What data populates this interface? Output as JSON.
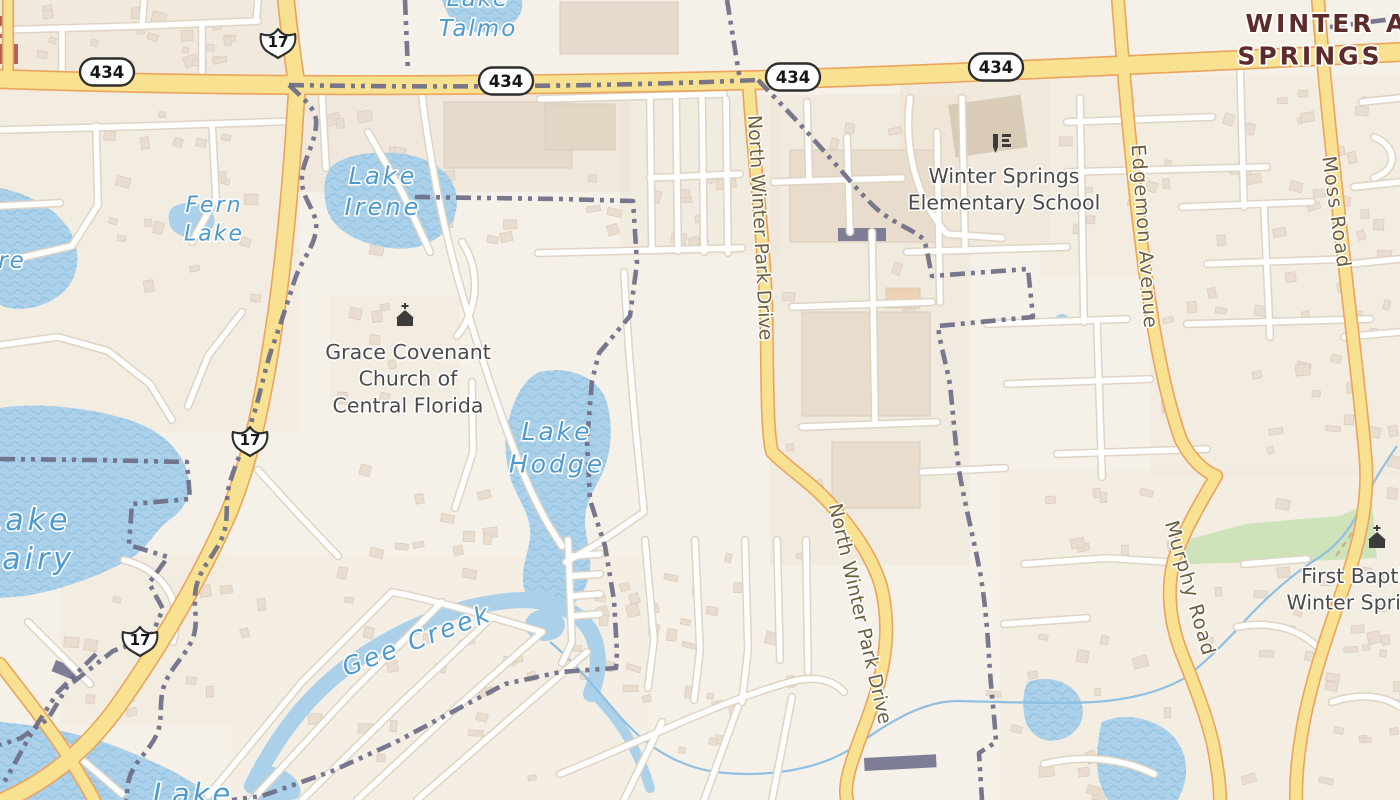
{
  "map": {
    "width": 1400,
    "height": 800,
    "colors": {
      "land": "#f6f1e8",
      "water": "#abd0ea",
      "waterWave": "#96c5e2",
      "waterLabel": "#4f9acc",
      "roadYellow": "#f8e292",
      "roadCasing": "#eca35c",
      "whiteRoad": "#ffffff",
      "whiteCasing": "#ded4c4",
      "boundary": "#6d6d86",
      "green": "#cfe3ba",
      "trail": "#cbb489",
      "building": "#e8ddcf",
      "buildingStroke": "#d8ccbc",
      "darkBuilding": "#7d7d95",
      "redBuilding": "#b2605c",
      "cityLabel": "#5e2b2b",
      "poiLabel": "#4b4b4b",
      "roadLabel": "#6e5e3e",
      "stream": "#8fc0e2",
      "shieldStroke": "#2e2e2e"
    },
    "landuse": [
      [
        0,
        0,
        300,
        92,
        "#ebe1d1",
        0.55
      ],
      [
        300,
        92,
        330,
        100,
        "#eae0d0",
        0.5
      ],
      [
        0,
        92,
        300,
        340,
        "#efe6d8",
        0.4
      ],
      [
        620,
        95,
        160,
        160,
        "#eee4d5",
        0.45
      ],
      [
        770,
        95,
        200,
        470,
        "#ebe2d3",
        0.45
      ],
      [
        900,
        80,
        150,
        165,
        "#ece2d2",
        0.55
      ],
      [
        1040,
        75,
        360,
        200,
        "#f0e7d9",
        0.5
      ],
      [
        1150,
        275,
        250,
        200,
        "#f0e7d9",
        0.45
      ],
      [
        1000,
        470,
        400,
        330,
        "#f0e8db",
        0.45
      ],
      [
        230,
        555,
        420,
        245,
        "#f2ebdf",
        0.5
      ],
      [
        60,
        555,
        170,
        170,
        "#efe6d8",
        0.4
      ],
      [
        330,
        295,
        130,
        110,
        "#efe6d8",
        0.4
      ]
    ],
    "green_areas": [
      "M1178,542 L1246,524 L1300,519 L1340,516 L1372,502 L1377,558 L1310,561 L1186,564 Z"
    ],
    "green_trails": [
      "M1336,556 C1344,544 1352,534 1358,522"
    ],
    "water": [
      {
        "id": "lake-talmo",
        "wave": true,
        "d": "M442,0 L522,0 C524,12 516,25 500,30 C480,36 458,30 450,18 C446,10 443,4 442,0 Z"
      },
      {
        "id": "lake-irene",
        "wave": true,
        "d": "M330,168 C345,152 390,148 420,158 C450,168 462,190 455,215 C448,238 420,252 390,248 C355,243 330,228 326,205 C323,190 324,178 330,168 Z"
      },
      {
        "id": "fern-pond",
        "wave": false,
        "d": "M172,208 C182,200 205,202 212,212 C218,222 212,234 198,237 C184,240 170,232 169,222 C168,215 169,211 172,208 Z"
      },
      {
        "id": "left-lake",
        "wave": true,
        "d": "M0,188 C30,194 60,210 72,235 C82,258 78,280 60,295 C40,310 15,312 0,305 Z"
      },
      {
        "id": "lake-hodge",
        "wave": true,
        "d": "M540,372 C570,365 598,378 606,400 C614,425 612,455 600,478 C592,494 585,505 585,520 C585,538 592,552 590,570 C587,592 575,608 558,612 C542,615 528,605 524,588 C520,570 528,555 530,538 C532,522 524,508 516,492 C505,470 502,440 510,415 C516,395 525,378 540,372 Z"
      },
      {
        "id": "lake-fairy",
        "wave": true,
        "d": "M0,408 C40,402 95,408 135,422 C162,432 178,448 186,468 C192,486 190,505 172,518 C152,532 150,548 128,560 C100,576 60,590 25,596 L0,598 Z"
      },
      {
        "id": "bottom-lake",
        "wave": true,
        "d": "M0,722 C40,725 90,735 130,752 C170,768 200,785 215,800 L0,800 Z"
      },
      {
        "id": "bottom-pond",
        "wave": false,
        "d": "M252,768 C275,762 295,772 300,788 C302,796 298,800 290,800 L255,800 C250,785 248,775 252,768 Z"
      },
      {
        "id": "creek-bulge",
        "wave": false,
        "d": "M525,625 a20,16 0 1,0 40,0 a20,16 0 1,0 -40,0 Z"
      },
      {
        "id": "pond-se-1",
        "wave": true,
        "d": "M1028,682 C1045,675 1068,680 1078,695 C1088,712 1082,730 1065,738 C1048,745 1032,738 1026,722 C1022,708 1022,692 1028,682 Z"
      },
      {
        "id": "pond-se-2",
        "wave": true,
        "d": "M1102,722 C1125,712 1155,718 1172,735 C1188,752 1190,775 1180,795 L1178,800 L1108,800 C1098,785 1095,765 1098,745 C1099,735 1100,728 1102,722 Z"
      },
      {
        "id": "pond-tiny",
        "wave": false,
        "d": "M1055,320 a7,6 0 1,0 14,0 a7,6 0 1,0 -14,0 Z"
      }
    ],
    "creek_strokes": [
      {
        "w": 16,
        "d": "M252,786 C282,726 317,686 362,656 C407,626 457,606 507,601 C547,597 577,608 591,632 C601,652 599,674 591,694"
      },
      {
        "w": 10,
        "d": "M589,690 C615,712 638,748 650,788"
      }
    ],
    "streams": [
      "M1397,446 C1380,470 1370,488 1362,505 C1348,535 1332,550 1312,562 C1285,580 1262,602 1242,624 C1222,646 1205,662 1188,676 C1162,692 1128,700 1094,702 C1055,704 1000,702 960,701 C920,700 885,726 852,748 C818,770 766,778 716,772 C673,766 641,742 616,712 C592,684 570,658 550,642"
    ],
    "yellow_roads": [
      {
        "id": "sr-434",
        "w": 17,
        "d": "M0,79 C250,88 520,86 760,80 C950,74 1200,62 1400,52"
      },
      {
        "id": "us-17-north",
        "w": 15,
        "d": "M286,0 C289,30 293,60 297,86"
      },
      {
        "id": "us-17-south",
        "w": 15,
        "d": "M297,86 C292,170 285,260 272,340 C262,405 250,460 230,510 C205,568 165,640 118,706 C85,752 45,782 5,800"
      },
      {
        "id": "sw-secondary",
        "w": 11,
        "d": "M0,664 C28,700 48,726 64,750 C78,772 88,788 94,800"
      },
      {
        "id": "north-winter-park-drive",
        "w": 11,
        "d": "M749,88 C753,150 763,230 766,300 C768,370 766,425 772,452 C790,470 812,483 832,506 C852,529 872,556 881,586 C888,614 888,645 880,678 C872,712 858,740 850,768 C846,782 845,792 847,800"
      },
      {
        "id": "edgemon-avenue",
        "w": 11,
        "d": "M1118,0 C1124,80 1131,160 1141,240 C1151,320 1163,390 1181,440 C1192,461 1204,471 1216,476"
      },
      {
        "id": "murphy-road",
        "w": 11,
        "d": "M1216,476 C1200,504 1184,530 1174,560 C1166,590 1170,624 1182,654 C1194,684 1206,714 1213,744 C1218,770 1220,788 1220,800"
      },
      {
        "id": "moss-road",
        "w": 11,
        "d": "M1318,0 C1325,90 1335,180 1345,268 C1353,340 1363,420 1366,465 C1368,506 1359,546 1344,586 C1329,630 1311,680 1303,726 C1297,760 1296,780 1296,800"
      },
      {
        "id": "left-edge-stub",
        "w": 9,
        "d": "M8,0 L8,72"
      }
    ],
    "white_roads": [
      "M0,30 L140,26 L258,21",
      "M142,26 L144,0",
      "M256,21 L258,0",
      "M62,28 L62,80",
      "M202,24 L202,80",
      "M0,130 L150,126 L300,121",
      "M96,126 L98,205 L72,246 L20,258",
      "M212,124 L216,198 L192,242",
      "M0,206 L60,203",
      "M0,345 L58,337 L108,351 L150,384 L172,420",
      "M242,312 L208,356 L188,406",
      "M258,470 L300,516 L338,556",
      "M124,560 C163,570 184,600 173,642",
      "M28,622 L90,684",
      "M64,744 L122,794",
      "M322,96 L326,168",
      "M422,96 C430,162 444,232 464,300 C482,360 502,420 522,470 C534,500 548,526 562,546",
      "M368,132 L402,192 L430,252",
      "M462,242 C482,272 477,312 457,336",
      "M472,382 L473,452 L455,508",
      "M624,272 L629,352 L636,432 L644,512",
      "M644,512 L602,541 L566,562",
      "M540,99 L724,94",
      "M650,99 L652,250",
      "M676,99 L678,251",
      "M702,99 L704,252",
      "M726,99 L728,253",
      "M650,178 L740,174",
      "M538,253 L742,248",
      "M208,796 L302,682 L392,592",
      "M252,800 L352,692 L442,602",
      "M302,800 L402,702 L492,617",
      "M357,800 L457,707 L542,632",
      "M417,800 L512,717 L587,652",
      "M392,592 C442,602 492,617 542,632",
      "M568,540 L572,642 L562,663",
      "M572,556 L600,554",
      "M572,576 L600,574",
      "M572,596 L600,594",
      "M572,616 L600,614",
      "M645,540 L654,640 L648,688",
      "M695,540 L700,650 L694,700",
      "M745,540 L748,650 L742,702",
      "M777,540 L780,660",
      "M806,540 L808,672",
      "M560,774 C640,742 718,702 790,682 C816,675 833,680 844,692",
      "M624,800 L662,722",
      "M704,800 L738,707",
      "M772,800 L792,697",
      "M774,182 L902,178",
      "M792,307 L932,302",
      "M802,427 L937,422",
      "M937,132 L940,302",
      "M872,232 L875,422",
      "M807,102 L809,178",
      "M847,137 L850,232",
      "M922,472 L1005,468",
      "M962,98 L965,247",
      "M907,252 L1067,247",
      "M910,98 C904,145 914,196 947,234 L1002,238",
      "M1067,122 L1212,117",
      "M1067,172 L1267,167",
      "M987,324 L1127,319",
      "M1182,207 L1312,202",
      "M1207,264 L1347,259",
      "M1187,324 L1370,319",
      "M1007,384 L1150,379",
      "M1057,454 L1207,449",
      "M1080,98 L1084,322",
      "M1240,64 L1244,207",
      "M1264,207 L1270,337",
      "M1097,324 L1102,477",
      "M1362,102 L1400,98",
      "M1354,187 L1400,182",
      "M1350,264 L1400,259",
      "M1344,337 L1400,332",
      "M1374,137 C1398,147 1398,170 1374,178",
      "M1024,564 L1107,558 L1167,562",
      "M1004,624 L1087,618",
      "M1244,564 L1307,559",
      "M1237,627 C1274,620 1304,630 1324,654",
      "M1044,764 C1084,754 1124,759 1154,774",
      "M1332,702 C1362,692 1387,697 1400,707"
    ],
    "boundaries": [
      "M405,0 L408,72",
      "M727,0 L740,80",
      "M289,85 C450,88 620,86 758,80",
      "M758,80 C775,98 795,118 814,140 C838,166 858,192 878,210 C898,226 915,230 924,240 C928,252 929,264 932,276 L1028,269 L1033,317 L938,326 C940,345 946,362 950,385 C953,412 955,440 959,470 C965,505 974,540 980,572 C986,606 988,640 990,672 C992,700 995,722 996,742 L979,753 C980,770 981,785 982,800",
      "M289,85 C305,100 318,110 316,126 C314,148 300,164 302,184 C304,202 318,212 316,230 C314,248 300,262 294,282 C287,304 280,326 272,348 C264,372 260,396 252,420 C246,442 236,462 230,482 C224,502 230,520 222,538 C214,556 200,568 196,588 C192,606 200,622 192,640 C184,658 170,668 164,686 C158,704 164,720 156,736 C148,752 136,760 130,776 C126,788 128,794 126,800",
      "M0,459 L92,460 L187,462 L190,499 L132,504 L129,545 L168,557 L149,583 L163,609 L151,637 L113,651 L67,687 L48,719 L21,738 L0,745",
      "M96,654 L58,692 L32,732 L10,772 L2,786",
      "M415,197 L560,199 L633,201 L637,263 L630,316 L599,353 L592,381 L587,441 L590,500 L605,546 L614,600 L617,652 L616,668 L560,672 L505,684 L452,712 L396,742 L330,772 L262,796 L232,800",
      "M1330,27 L1400,18"
    ],
    "big_buildings": [
      {
        "x": 560,
        "y": 2,
        "w": 118,
        "h": 52,
        "rot": 0,
        "fill": "#e5dacb"
      },
      {
        "x": 444,
        "y": 102,
        "w": 128,
        "h": 66,
        "rot": 0,
        "fill": "#e5dacb"
      },
      {
        "x": 545,
        "y": 104,
        "w": 70,
        "h": 46,
        "rot": 0,
        "fill": "#e2d6c5"
      },
      {
        "x": 790,
        "y": 150,
        "w": 148,
        "h": 92,
        "rot": 0,
        "fill": "#e8ddcc"
      },
      {
        "x": 802,
        "y": 312,
        "w": 128,
        "h": 104,
        "rot": 0,
        "fill": "#e8ddcc"
      },
      {
        "x": 832,
        "y": 442,
        "w": 88,
        "h": 66,
        "rot": 0,
        "fill": "#e8ddcc"
      },
      {
        "x": 952,
        "y": 100,
        "w": 72,
        "h": 52,
        "rot": -8,
        "fill": "#d9cbb6"
      },
      {
        "x": 886,
        "y": 288,
        "w": 34,
        "h": 20,
        "rot": 0,
        "fill": "#edd2b4"
      }
    ],
    "dark_buildings": [
      {
        "x": 838,
        "y": 228,
        "w": 48,
        "h": 13,
        "rot": 0
      },
      {
        "x": 864,
        "y": 758,
        "w": 72,
        "h": 13,
        "rot": -3
      },
      {
        "x": 56,
        "y": 660,
        "w": 26,
        "h": 12,
        "rot": 22
      }
    ],
    "red_buildings": [
      {
        "x": 0,
        "y": 16,
        "w": 14,
        "h": 22
      },
      {
        "x": 0,
        "y": 44,
        "w": 18,
        "h": 20
      }
    ],
    "building_zones": [
      [
        10,
        5,
        250,
        60,
        22
      ],
      [
        95,
        100,
        180,
        240,
        20
      ],
      [
        320,
        110,
        290,
        140,
        18
      ],
      [
        640,
        110,
        100,
        140,
        10
      ],
      [
        300,
        460,
        240,
        110,
        14
      ],
      [
        230,
        585,
        380,
        195,
        24
      ],
      [
        590,
        545,
        230,
        230,
        30
      ],
      [
        780,
        110,
        170,
        380,
        12
      ],
      [
        1050,
        85,
        330,
        170,
        34
      ],
      [
        1160,
        270,
        230,
        190,
        26
      ],
      [
        1010,
        480,
        380,
        300,
        34
      ],
      [
        1240,
        560,
        160,
        220,
        18
      ],
      [
        980,
        625,
        200,
        165,
        12
      ],
      [
        330,
        300,
        120,
        100,
        8
      ],
      [
        60,
        560,
        160,
        160,
        10
      ]
    ],
    "labels": [
      {
        "id": "lake-talmo",
        "lines": [
          "Lake",
          "Talmo"
        ],
        "x": 478,
        "y": 6,
        "cls": "water",
        "size": 23,
        "ls": 2,
        "rot": 0
      },
      {
        "id": "fern-lake",
        "lines": [
          "Fern",
          "Lake"
        ],
        "x": 214,
        "y": 212,
        "cls": "water",
        "size": 22,
        "ls": 2,
        "rot": 0
      },
      {
        "id": "lake-irene",
        "lines": [
          "Lake",
          "Irene"
        ],
        "x": 383,
        "y": 184,
        "cls": "water",
        "size": 24,
        "ls": 3,
        "rot": 0
      },
      {
        "id": "lake-hodge",
        "lines": [
          "Lake",
          "Hodge"
        ],
        "x": 557,
        "y": 440,
        "cls": "water",
        "size": 25,
        "ls": 3,
        "rot": 0
      },
      {
        "id": "lake-fairy",
        "lines": [
          "Lake",
          "Fairy"
        ],
        "x": 28,
        "y": 530,
        "cls": "water",
        "size": 30,
        "ls": 4,
        "rot": 0
      },
      {
        "id": "gee-creek",
        "lines": [
          "Gee Creek"
        ],
        "x": 420,
        "y": 648,
        "cls": "water",
        "size": 25,
        "ls": 3,
        "rot": -21
      },
      {
        "id": "bottom-lake",
        "lines": [
          "Lake"
        ],
        "x": 193,
        "y": 804,
        "cls": "water",
        "size": 29,
        "ls": 3,
        "rot": 0
      },
      {
        "id": "left-partial",
        "lines": [
          "re"
        ],
        "x": 12,
        "y": 268,
        "cls": "water",
        "size": 23,
        "ls": 2,
        "rot": 0
      },
      {
        "id": "winter-springs-city",
        "lines": [
          "WINTER",
          "SPRINGS"
        ],
        "x": 1310,
        "y": 32,
        "cls": "city",
        "size": 25,
        "ls": 3,
        "rot": 0
      },
      {
        "id": "partial-a",
        "lines": [
          "A"
        ],
        "x": 1397,
        "y": 32,
        "cls": "city",
        "size": 25,
        "ls": 3,
        "rot": 0
      },
      {
        "id": "winter-springs-elementary",
        "lines": [
          "Winter Springs",
          "Elementary School"
        ],
        "x": 1004,
        "y": 183,
        "cls": "poi",
        "size": 20.5,
        "ls": 0,
        "rot": 0
      },
      {
        "id": "grace-covenant-church",
        "lines": [
          "Grace Covenant",
          "Church of",
          "Central Florida"
        ],
        "x": 408,
        "y": 359,
        "cls": "poi",
        "size": 20.5,
        "ls": 0,
        "rot": 0
      },
      {
        "id": "first-baptist-church",
        "lines": [
          "First Baptist",
          "Winter Springs"
        ],
        "x": 1362,
        "y": 583,
        "cls": "poi",
        "size": 20.5,
        "ls": 0,
        "rot": 0
      },
      {
        "id": "north-winter-park-drive-upper",
        "lines": [
          "North Winter Park Drive"
        ],
        "x": 754,
        "y": 228,
        "cls": "road",
        "size": 19,
        "ls": 0,
        "rot": 87
      },
      {
        "id": "north-winter-park-drive-lower",
        "lines": [
          "North Winter Park Drive"
        ],
        "x": 854,
        "y": 615,
        "cls": "road",
        "size": 19,
        "ls": 0,
        "rot": 77
      },
      {
        "id": "edgemon-avenue",
        "lines": [
          "Edgemon Avenue"
        ],
        "x": 1138,
        "y": 237,
        "cls": "road",
        "size": 19.5,
        "ls": 1,
        "rot": 86
      },
      {
        "id": "moss-road",
        "lines": [
          "Moss Road"
        ],
        "x": 1330,
        "y": 213,
        "cls": "road",
        "size": 19.5,
        "ls": 1,
        "rot": 82
      },
      {
        "id": "murphy-road",
        "lines": [
          "Murphy Road"
        ],
        "x": 1184,
        "y": 590,
        "cls": "road",
        "size": 19.5,
        "ls": 1,
        "rot": 74
      }
    ],
    "shields": [
      {
        "type": "us",
        "text": "17",
        "x": 278,
        "y": 41
      },
      {
        "type": "us",
        "text": "17",
        "x": 250,
        "y": 439
      },
      {
        "type": "us",
        "text": "17",
        "x": 140,
        "y": 639
      },
      {
        "type": "state",
        "text": "434",
        "x": 107,
        "y": 72
      },
      {
        "type": "state",
        "text": "434",
        "x": 506,
        "y": 81
      },
      {
        "type": "state",
        "text": "434",
        "x": 793,
        "y": 77
      },
      {
        "type": "state",
        "text": "434",
        "x": 996,
        "y": 67
      }
    ],
    "pois": [
      {
        "icon": "church",
        "x": 405,
        "y": 320
      },
      {
        "icon": "school",
        "x": 1002,
        "y": 143
      },
      {
        "icon": "church",
        "x": 1377,
        "y": 542
      }
    ]
  }
}
